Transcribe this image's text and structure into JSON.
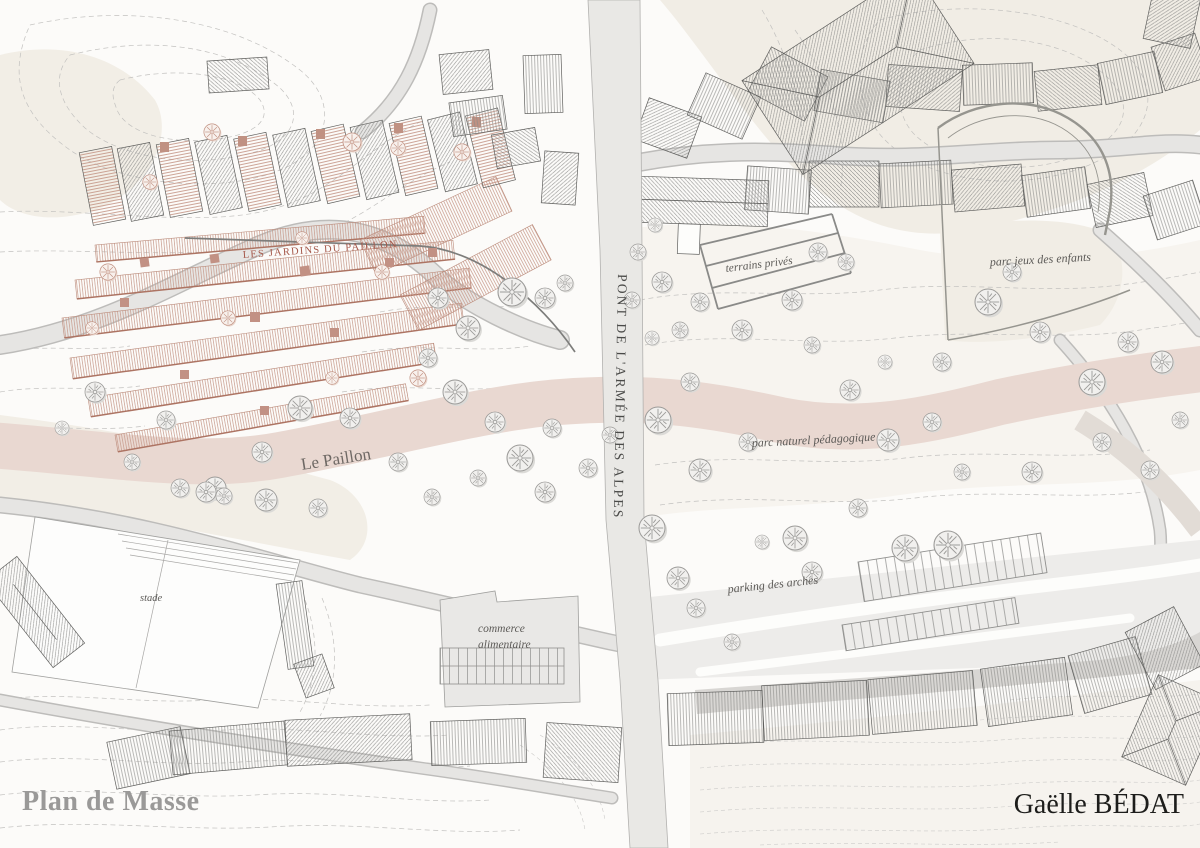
{
  "title": "Plan de Masse",
  "author": "Gaëlle BÉDAT",
  "map_labels": {
    "bridge": "PONT DE L'ARMÉE DES ALPES",
    "river": "Le Paillon",
    "gardens": "LES JARDINS DU PAILLON",
    "private_grounds": "terrains privés",
    "playground": "parc jeux des enfants",
    "nature_park": "parc naturel pédagogique",
    "parking": "parking des arches",
    "stadium": "stade",
    "shop_line1": "commerce",
    "shop_line2": "alimentaire"
  },
  "colors": {
    "river_pink": "#e9d8d1",
    "terrace_red": "#c5968a",
    "gardens_label_red": "#a5584a",
    "road_gray": "#e6e5e3",
    "hill_ivory": "#f2eee6",
    "title_gray": "#9a9998",
    "ink": "#1d1d1b"
  }
}
